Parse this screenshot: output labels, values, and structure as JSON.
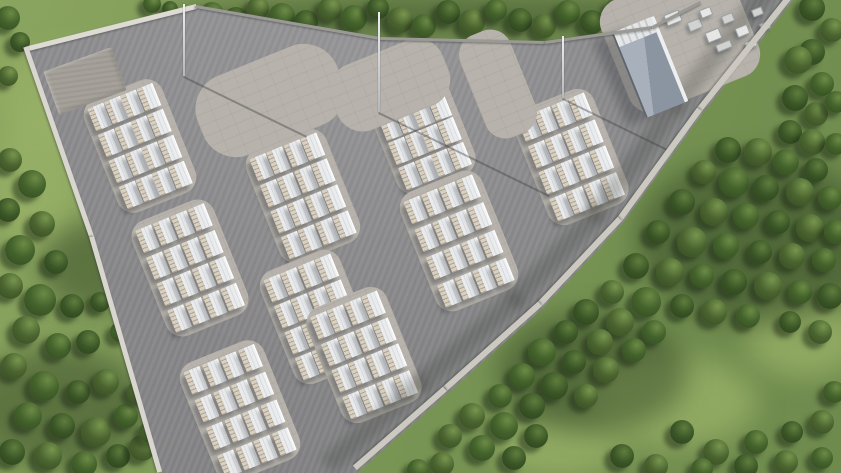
{
  "scene": {
    "kind": "aerial-3d-render",
    "subject": "battery-energy-storage-facility"
  },
  "palette": {
    "grass": "#7b9756",
    "asphalt": "#8c8c8e",
    "concrete_pad": "#b7b3ac",
    "unit_roof": "#f6f7f8",
    "unit_face": "#d7d1c5",
    "vent_tan": "#967c55",
    "building_roof": "#8b95a1",
    "wall_light": "#d9d6cf",
    "tree_dark": "#32481f"
  },
  "site": {
    "boundary": [
      [
        28,
        48
      ],
      [
        196,
        6
      ],
      [
        380,
        38
      ],
      [
        545,
        42
      ],
      [
        652,
        27
      ],
      [
        696,
        4
      ],
      [
        700,
        0
      ],
      [
        793,
        0
      ],
      [
        702,
        114
      ],
      [
        622,
        224
      ],
      [
        542,
        309
      ],
      [
        447,
        394
      ],
      [
        357,
        473
      ],
      [
        162,
        473
      ],
      [
        94,
        238
      ]
    ]
  },
  "pads": [
    {
      "cx": 140,
      "cy": 146,
      "w": 84,
      "h": 122,
      "rot": -22,
      "r": 18,
      "type": "cluster"
    },
    {
      "cx": 303,
      "cy": 196,
      "w": 86,
      "h": 122,
      "rot": -22,
      "r": 18,
      "type": "cluster"
    },
    {
      "cx": 420,
      "cy": 129,
      "w": 84,
      "h": 118,
      "rot": -22,
      "r": 18,
      "type": "cluster"
    },
    {
      "cx": 571,
      "cy": 157,
      "w": 86,
      "h": 124,
      "rot": -22,
      "r": 18,
      "type": "cluster"
    },
    {
      "cx": 190,
      "cy": 268,
      "w": 88,
      "h": 124,
      "rot": -22,
      "r": 18,
      "type": "cluster"
    },
    {
      "cx": 317,
      "cy": 317,
      "w": 86,
      "h": 122,
      "rot": -22,
      "r": 18,
      "type": "cluster"
    },
    {
      "cx": 459,
      "cy": 241,
      "w": 88,
      "h": 128,
      "rot": -22,
      "r": 18,
      "type": "cluster"
    },
    {
      "cx": 240,
      "cy": 411,
      "w": 90,
      "h": 128,
      "rot": -22,
      "r": 18,
      "type": "cluster"
    },
    {
      "cx": 364,
      "cy": 355,
      "w": 86,
      "h": 124,
      "rot": -22,
      "r": 18,
      "type": "cluster"
    },
    {
      "cx": 270,
      "cy": 100,
      "w": 150,
      "h": 85,
      "rot": -22,
      "r": 36,
      "type": "apron"
    },
    {
      "cx": 390,
      "cy": 85,
      "w": 120,
      "h": 70,
      "rot": -22,
      "r": 28,
      "type": "apron"
    },
    {
      "cx": 498,
      "cy": 84,
      "w": 54,
      "h": 110,
      "rot": -22,
      "r": 22,
      "type": "apron"
    },
    {
      "cx": 680,
      "cy": 38,
      "w": 140,
      "h": 120,
      "rot": -22,
      "r": 24,
      "type": "apron"
    },
    {
      "cx": 85,
      "cy": 81,
      "w": 72,
      "h": 46,
      "rot": -20,
      "r": 2,
      "type": "gravel"
    }
  ],
  "unit_grid": {
    "cols": 4,
    "rows": 4,
    "unit_w": 17,
    "unit_h": 24,
    "padding": 7
  },
  "building": {
    "cx": 650,
    "cy": 67,
    "w": 46,
    "h": 92,
    "rot": -22
  },
  "equipment": [
    [
      665,
      12,
      16,
      12
    ],
    [
      688,
      20,
      14,
      10
    ],
    [
      706,
      30,
      15,
      11
    ],
    [
      722,
      14,
      12,
      9
    ],
    [
      736,
      26,
      13,
      10
    ],
    [
      752,
      8,
      11,
      8
    ],
    [
      700,
      8,
      12,
      9
    ],
    [
      716,
      42,
      16,
      8
    ],
    [
      745,
      40,
      12,
      8
    ],
    [
      760,
      22,
      10,
      8
    ]
  ],
  "masts": [
    [
      184,
      4,
      72
    ],
    [
      379,
      12,
      100
    ],
    [
      563,
      36,
      62
    ]
  ],
  "walls": [
    {
      "x1": 28,
      "y1": 48,
      "x2": 196,
      "y2": 6,
      "w": 5,
      "color": "#dedbd4",
      "posts": false,
      "shade": false
    },
    {
      "x1": 28,
      "y1": 48,
      "x2": 94,
      "y2": 238,
      "w": 5,
      "color": "#d9d6cf",
      "posts": false,
      "shade": false
    },
    {
      "x1": 94,
      "y1": 238,
      "x2": 162,
      "y2": 473,
      "w": 5,
      "color": "#d9d6cf",
      "posts": false,
      "shade": false
    },
    {
      "x1": 196,
      "y1": 6,
      "x2": 380,
      "y2": 38,
      "w": 3,
      "color": "#9b9995",
      "posts": true,
      "shade": false
    },
    {
      "x1": 380,
      "y1": 38,
      "x2": 545,
      "y2": 42,
      "w": 3,
      "color": "#9b9995",
      "posts": true,
      "shade": false
    },
    {
      "x1": 545,
      "y1": 42,
      "x2": 652,
      "y2": 27,
      "w": 3,
      "color": "#9b9995",
      "posts": true,
      "shade": false
    },
    {
      "x1": 652,
      "y1": 27,
      "x2": 700,
      "y2": 2,
      "w": 3,
      "color": "#9b9995",
      "posts": true,
      "shade": false
    },
    {
      "x1": 793,
      "y1": 0,
      "x2": 702,
      "y2": 114,
      "w": 6,
      "color": "#ccc9c1",
      "posts": true,
      "shade": true
    },
    {
      "x1": 702,
      "y1": 114,
      "x2": 622,
      "y2": 224,
      "w": 6,
      "color": "#ccc9c1",
      "posts": true,
      "shade": true
    },
    {
      "x1": 622,
      "y1": 224,
      "x2": 542,
      "y2": 309,
      "w": 6,
      "color": "#ccc9c1",
      "posts": true,
      "shade": true
    },
    {
      "x1": 542,
      "y1": 309,
      "x2": 447,
      "y2": 394,
      "w": 6,
      "color": "#ccc9c1",
      "posts": true,
      "shade": true
    },
    {
      "x1": 447,
      "y1": 394,
      "x2": 357,
      "y2": 473,
      "w": 6,
      "color": "#ccc9c1",
      "posts": true,
      "shade": true
    }
  ],
  "grass": {
    "light_patches": [
      [
        80,
        96,
        170,
        100
      ],
      [
        672,
        402,
        170,
        90
      ],
      [
        806,
        338,
        120,
        80
      ],
      [
        560,
        448,
        130,
        60
      ],
      [
        36,
        180,
        90,
        140
      ]
    ],
    "dark_patches": [
      [
        420,
        16,
        520,
        40
      ],
      [
        756,
        240,
        240,
        170
      ],
      [
        592,
        372,
        190,
        120
      ],
      [
        58,
        408,
        180,
        120
      ],
      [
        100,
        266,
        120,
        90
      ]
    ]
  },
  "trees": [
    [
      212,
      14,
      12
    ],
    [
      236,
      20,
      13
    ],
    [
      258,
      8,
      11
    ],
    [
      282,
      16,
      13
    ],
    [
      306,
      22,
      12
    ],
    [
      330,
      9,
      12
    ],
    [
      354,
      18,
      13
    ],
    [
      378,
      8,
      11
    ],
    [
      400,
      20,
      13
    ],
    [
      424,
      26,
      12
    ],
    [
      448,
      12,
      12
    ],
    [
      472,
      22,
      13
    ],
    [
      496,
      10,
      11
    ],
    [
      520,
      20,
      12
    ],
    [
      544,
      26,
      12
    ],
    [
      568,
      12,
      12
    ],
    [
      592,
      22,
      12
    ],
    [
      616,
      9,
      11
    ],
    [
      662,
      6,
      11
    ],
    [
      812,
      8,
      13
    ],
    [
      832,
      30,
      12
    ],
    [
      8,
      18,
      12
    ],
    [
      20,
      42,
      10
    ],
    [
      8,
      76,
      10
    ],
    [
      152,
      4,
      9
    ],
    [
      170,
      9,
      8
    ],
    [
      10,
      160,
      12
    ],
    [
      32,
      184,
      14
    ],
    [
      8,
      210,
      12
    ],
    [
      42,
      224,
      13
    ],
    [
      20,
      250,
      15
    ],
    [
      56,
      262,
      12
    ],
    [
      10,
      286,
      13
    ],
    [
      40,
      300,
      16
    ],
    [
      72,
      306,
      12
    ],
    [
      26,
      330,
      14
    ],
    [
      58,
      346,
      13
    ],
    [
      88,
      342,
      12
    ],
    [
      14,
      366,
      13
    ],
    [
      44,
      386,
      15
    ],
    [
      78,
      392,
      12
    ],
    [
      106,
      382,
      13
    ],
    [
      28,
      416,
      14
    ],
    [
      62,
      426,
      13
    ],
    [
      96,
      432,
      15
    ],
    [
      126,
      416,
      12
    ],
    [
      12,
      452,
      13
    ],
    [
      48,
      456,
      14
    ],
    [
      84,
      464,
      13
    ],
    [
      118,
      456,
      12
    ],
    [
      142,
      448,
      13
    ],
    [
      120,
      332,
      10
    ],
    [
      100,
      302,
      10
    ],
    [
      138,
      392,
      11
    ],
    [
      150,
      432,
      11
    ],
    [
      812,
      52,
      13
    ],
    [
      798,
      60,
      14
    ],
    [
      822,
      84,
      12
    ],
    [
      795,
      98,
      13
    ],
    [
      816,
      114,
      12
    ],
    [
      836,
      102,
      11
    ],
    [
      790,
      132,
      12
    ],
    [
      812,
      142,
      13
    ],
    [
      836,
      144,
      11
    ],
    [
      728,
      150,
      13
    ],
    [
      758,
      152,
      14
    ],
    [
      786,
      162,
      13
    ],
    [
      816,
      170,
      12
    ],
    [
      704,
      172,
      12
    ],
    [
      734,
      182,
      15
    ],
    [
      766,
      188,
      13
    ],
    [
      800,
      192,
      14
    ],
    [
      830,
      198,
      12
    ],
    [
      682,
      202,
      13
    ],
    [
      714,
      212,
      14
    ],
    [
      746,
      216,
      13
    ],
    [
      778,
      222,
      12
    ],
    [
      810,
      228,
      14
    ],
    [
      836,
      232,
      12
    ],
    [
      658,
      232,
      12
    ],
    [
      692,
      242,
      15
    ],
    [
      726,
      246,
      13
    ],
    [
      760,
      252,
      12
    ],
    [
      792,
      256,
      13
    ],
    [
      824,
      260,
      12
    ],
    [
      636,
      266,
      13
    ],
    [
      670,
      272,
      14
    ],
    [
      702,
      276,
      12
    ],
    [
      734,
      282,
      13
    ],
    [
      768,
      286,
      14
    ],
    [
      800,
      292,
      12
    ],
    [
      830,
      296,
      13
    ],
    [
      612,
      292,
      12
    ],
    [
      646,
      302,
      15
    ],
    [
      682,
      306,
      12
    ],
    [
      714,
      312,
      13
    ],
    [
      748,
      316,
      12
    ],
    [
      586,
      312,
      13
    ],
    [
      620,
      322,
      14
    ],
    [
      654,
      332,
      12
    ],
    [
      566,
      332,
      12
    ],
    [
      600,
      342,
      13
    ],
    [
      634,
      350,
      12
    ],
    [
      790,
      322,
      11
    ],
    [
      820,
      332,
      12
    ],
    [
      542,
      352,
      14
    ],
    [
      574,
      362,
      12
    ],
    [
      606,
      370,
      13
    ],
    [
      522,
      376,
      13
    ],
    [
      554,
      386,
      14
    ],
    [
      586,
      396,
      12
    ],
    [
      500,
      396,
      12
    ],
    [
      532,
      406,
      13
    ],
    [
      472,
      416,
      13
    ],
    [
      504,
      426,
      14
    ],
    [
      536,
      436,
      12
    ],
    [
      450,
      436,
      12
    ],
    [
      482,
      448,
      13
    ],
    [
      514,
      458,
      12
    ],
    [
      442,
      464,
      12
    ],
    [
      418,
      470,
      11
    ],
    [
      682,
      432,
      12
    ],
    [
      716,
      452,
      13
    ],
    [
      756,
      442,
      12
    ],
    [
      792,
      432,
      11
    ],
    [
      822,
      422,
      12
    ],
    [
      834,
      392,
      11
    ],
    [
      622,
      456,
      12
    ],
    [
      656,
      466,
      12
    ],
    [
      702,
      469,
      11
    ],
    [
      746,
      466,
      12
    ],
    [
      786,
      462,
      12
    ],
    [
      822,
      458,
      11
    ]
  ]
}
